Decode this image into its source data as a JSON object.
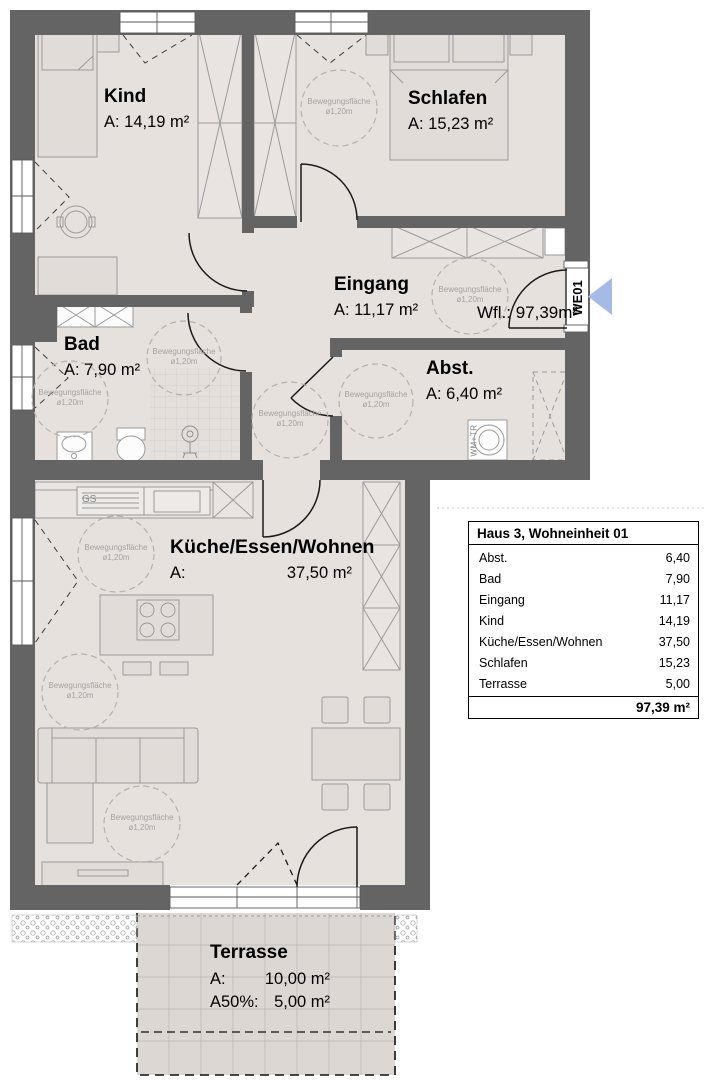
{
  "floorplan": {
    "rooms": {
      "kind": {
        "name": "Kind",
        "area": "A: 14,19 m²"
      },
      "schlafen": {
        "name": "Schlafen",
        "area": "A: 15,23 m²"
      },
      "eingang": {
        "name": "Eingang",
        "area": "A: 11,17 m²"
      },
      "bad": {
        "name": "Bad",
        "area": "A: 7,90 m²"
      },
      "abstellraum": {
        "name": "Abst.",
        "area": "A: 6,40 m²"
      },
      "kueche": {
        "name": "Küche/Essen/Wohnen",
        "area_label": "A:",
        "area_value": "37,50 m²"
      },
      "terrasse": {
        "name": "Terrasse",
        "area_label": "A:",
        "area_value": "10,00 m²",
        "area50_label": "A50%:",
        "area50_value": "5,00 m²"
      }
    },
    "annotations": {
      "living_area_label": "Wfl.: 97,39m²",
      "unit_tag": "WE01",
      "movement_area": {
        "line1": "Bewegungsfläche",
        "line2": "ø1,20m"
      },
      "dishwasher_label": "GS",
      "washer_dryer_label": "WM+TR"
    }
  },
  "area_table": {
    "title": "Haus 3, Wohneinheit 01",
    "rows": [
      {
        "label": "Abst.",
        "value": "6,40"
      },
      {
        "label": "Bad",
        "value": "7,90"
      },
      {
        "label": "Eingang",
        "value": "11,17"
      },
      {
        "label": "Kind",
        "value": "14,19"
      },
      {
        "label": "Küche/Essen/Wohnen",
        "value": "37,50"
      },
      {
        "label": "Schlafen",
        "value": "15,23"
      },
      {
        "label": "Terrasse",
        "value": "5,00"
      }
    ],
    "total": "97,39 m²"
  },
  "colors": {
    "wall": "#646464",
    "floor": "#e7e1de",
    "terrace": "#ddd7d3",
    "accent_arrow": "#a5bae7"
  }
}
